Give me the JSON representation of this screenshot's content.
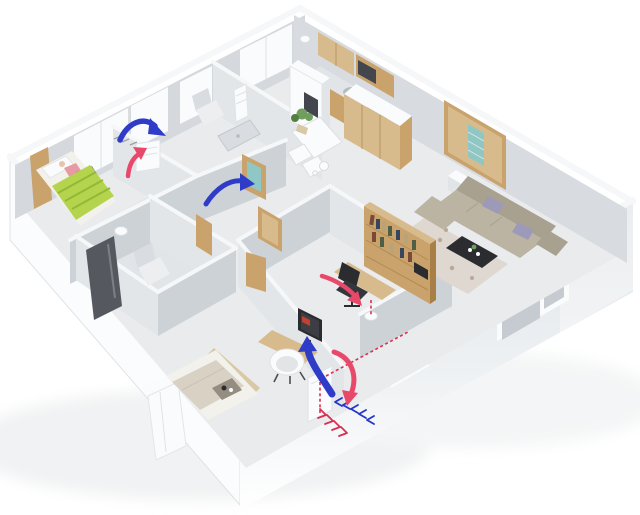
{
  "meta": {
    "description": "3D isometric cutaway floor plan render of an apartment showing a fresh-air ventilation system: blue supply airflow arrows, red exhaust airflow arrows, dashed duct lines and two wall-mounted ventilation units",
    "background": "#ffffff"
  },
  "colors": {
    "floor": "#e9ebed",
    "floorShade": "#e2e5e7",
    "wallTop": "#f5f7f8",
    "wallFaceLight": "#e3e6e9",
    "wallFaceDark": "#cdd2d7",
    "extInnerNW": "#d5d9dd",
    "extInnerNE": "#d8dbdf",
    "extOuterTop": "#e3e6e9",
    "extOuterBottom": "#ffffff",
    "extSide": "#fbfcfd",
    "edge": "#dfe3e6",
    "wood": "#c9a36b",
    "woodLight": "#d8bb8d",
    "woodDark": "#a87f46",
    "glass": "#c5cbd0",
    "glassTeal": "#8fc7c4",
    "white": "#fafbfc",
    "fridgeDark": "#43464c",
    "dark": "#2b2c2f",
    "sofa": "#bcb4a3",
    "sofaDark": "#a9a190",
    "pillow": "#9d99b8",
    "rug": "#dfd8d1",
    "rugDot": "#b9a79b",
    "bedGreen": "#b5d44e",
    "bedGreenDark": "#94b836",
    "bedLinen": "#f2f1ec",
    "blanketBeige": "#d8d1c4",
    "headboard": "#d9c8a4",
    "shower": "#55595f",
    "toiletLight": "#eceef0",
    "toiletMid": "#d9dce0",
    "plant": "#6f9e5d",
    "plantDark": "#547f43",
    "skin": "#e8c4a8",
    "shirt": "#e89aa4",
    "arrowBlue": "#2e3cc8",
    "arrowRed": "#e8486a",
    "ductRed": "#d93050",
    "ductBlue": "#2336c8",
    "lampShadow": "#d8dcdf",
    "metal": "#b7bcc1",
    "book1": "#7a4a36",
    "book2": "#35465e",
    "book3": "#b8a478",
    "book4": "#4f5e45"
  },
  "rooms": [
    {
      "id": "bedroom-child",
      "label": "child bedroom",
      "furniture": [
        "bed with green striped blanket",
        "person lying on bed",
        "wood headboard shelf",
        "double window",
        "wall ventilation unit"
      ]
    },
    {
      "id": "bathroom-small",
      "label": "small bathroom",
      "furniture": [
        "toilet",
        "towel radiator",
        "shower tray",
        "window"
      ]
    },
    {
      "id": "kitchen",
      "label": "kitchen",
      "furniture": [
        "upper wood cabinets",
        "counter with sink and cooktop",
        "refrigerator"
      ]
    },
    {
      "id": "dining",
      "label": "dining area",
      "furniture": [
        "white table",
        "plant",
        "two chairs",
        "kettle"
      ]
    },
    {
      "id": "entry",
      "label": "entry hall",
      "furniture": [
        "wood wardrobe",
        "front door with glass insert",
        "white side stool"
      ]
    },
    {
      "id": "living",
      "label": "living room",
      "furniture": [
        "l-shaped beige sofa",
        "lavender cushions",
        "dark coffee table",
        "floral rug",
        "window"
      ]
    },
    {
      "id": "bathroom-main",
      "label": "main bathroom",
      "furniture": [
        "dark shower panel",
        "toilet",
        "ceiling lamp"
      ]
    },
    {
      "id": "study",
      "label": "study",
      "furniture": [
        "wood bookshelf with books",
        "desk",
        "black office chair",
        "ceiling lamp",
        "window"
      ]
    },
    {
      "id": "bedroom-main",
      "label": "main bedroom",
      "furniture": [
        "bed with serving tray",
        "white wardrobe",
        "desk with monitor",
        "white tub chair",
        "window",
        "wall ventilation unit"
      ]
    }
  ],
  "airflow": {
    "supply_color_name": "blue",
    "exhaust_color_name": "red",
    "arrows": [
      {
        "id": "supply-into-child-bedroom",
        "type": "supply"
      },
      {
        "id": "exhaust-up-to-child-unit",
        "type": "exhaust"
      },
      {
        "id": "supply-through-hallway",
        "type": "supply"
      },
      {
        "id": "exhaust-in-study",
        "type": "exhaust"
      },
      {
        "id": "supply-into-main-bedroom",
        "type": "supply"
      },
      {
        "id": "exhaust-over-wall-to-unit",
        "type": "exhaust"
      }
    ],
    "ducts": [
      {
        "id": "exhaust-duct-dashed-on-wall",
        "type": "exhaust"
      },
      {
        "id": "exhaust-duct-dashed-on-unit",
        "type": "exhaust"
      },
      {
        "id": "exhaust-duct-to-study-lamp",
        "type": "exhaust"
      },
      {
        "id": "outlet-chevrons-outside",
        "type": "exhaust"
      },
      {
        "id": "intake-chevrons-outside",
        "type": "supply"
      }
    ],
    "units": [
      {
        "id": "vent-unit-child-bedroom"
      },
      {
        "id": "vent-unit-main-bedroom"
      }
    ]
  }
}
